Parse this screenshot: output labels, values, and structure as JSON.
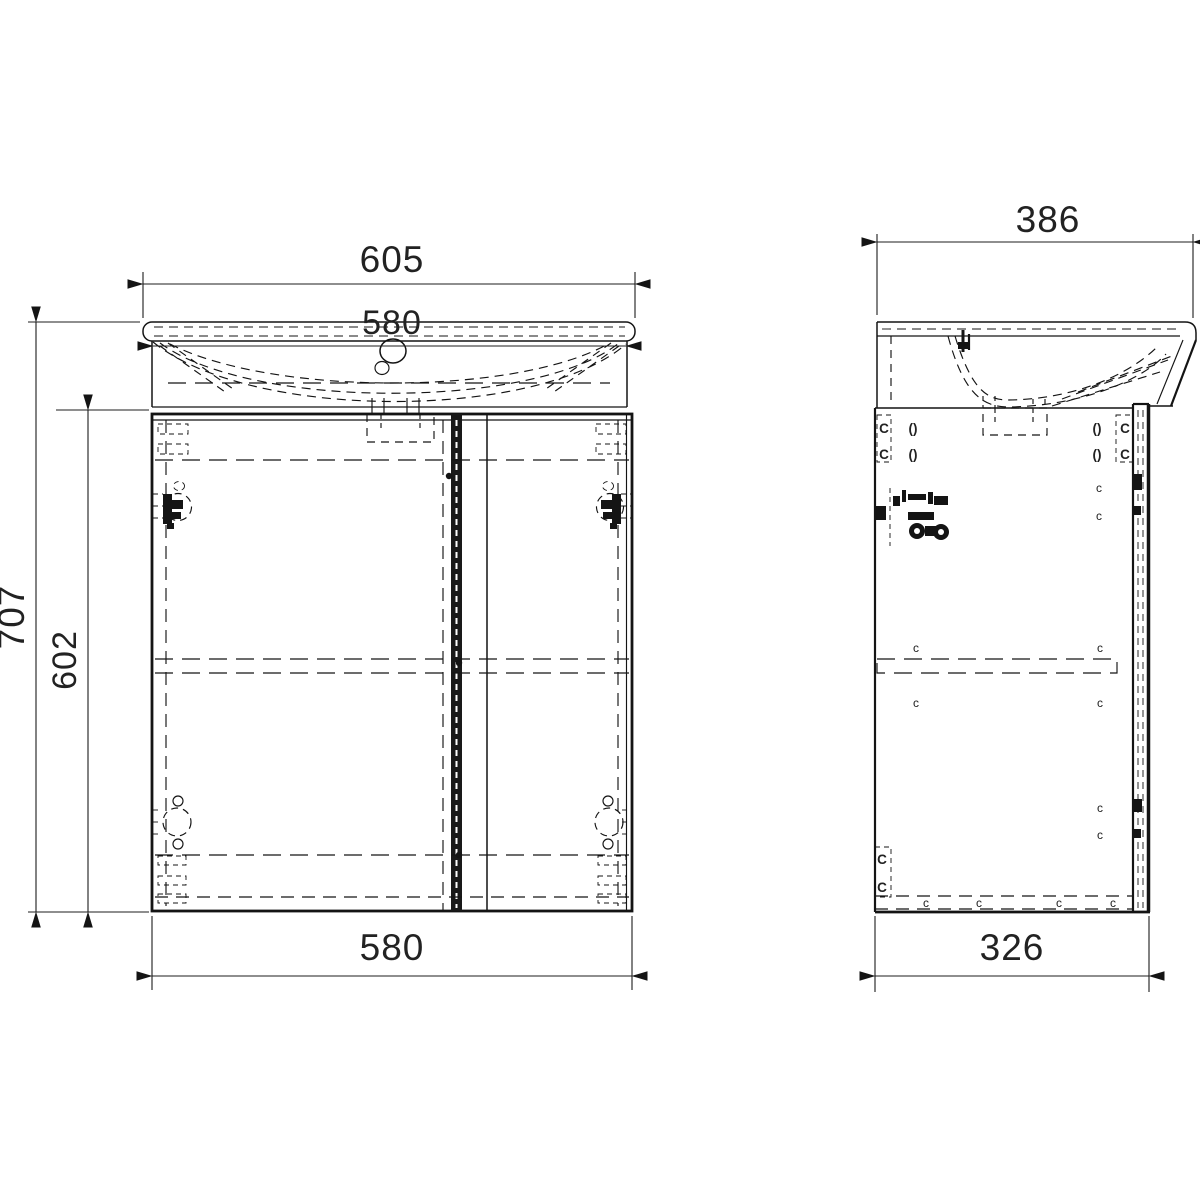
{
  "drawing_type": "bathroom vanity unit with washbasin - orthographic technical drawing",
  "front_view": {
    "dimensions": {
      "overall_width": "605",
      "basin_width": "580",
      "overall_height": "707",
      "cabinet_height": "602",
      "cabinet_width": "580"
    }
  },
  "side_view": {
    "dimensions": {
      "overall_depth": "386",
      "cabinet_depth": "326"
    }
  },
  "symbols": {
    "cam_lock": "C",
    "cam_small": "c",
    "dowel": "()"
  },
  "colors": {
    "line": "#141414",
    "background": "#ffffff"
  }
}
